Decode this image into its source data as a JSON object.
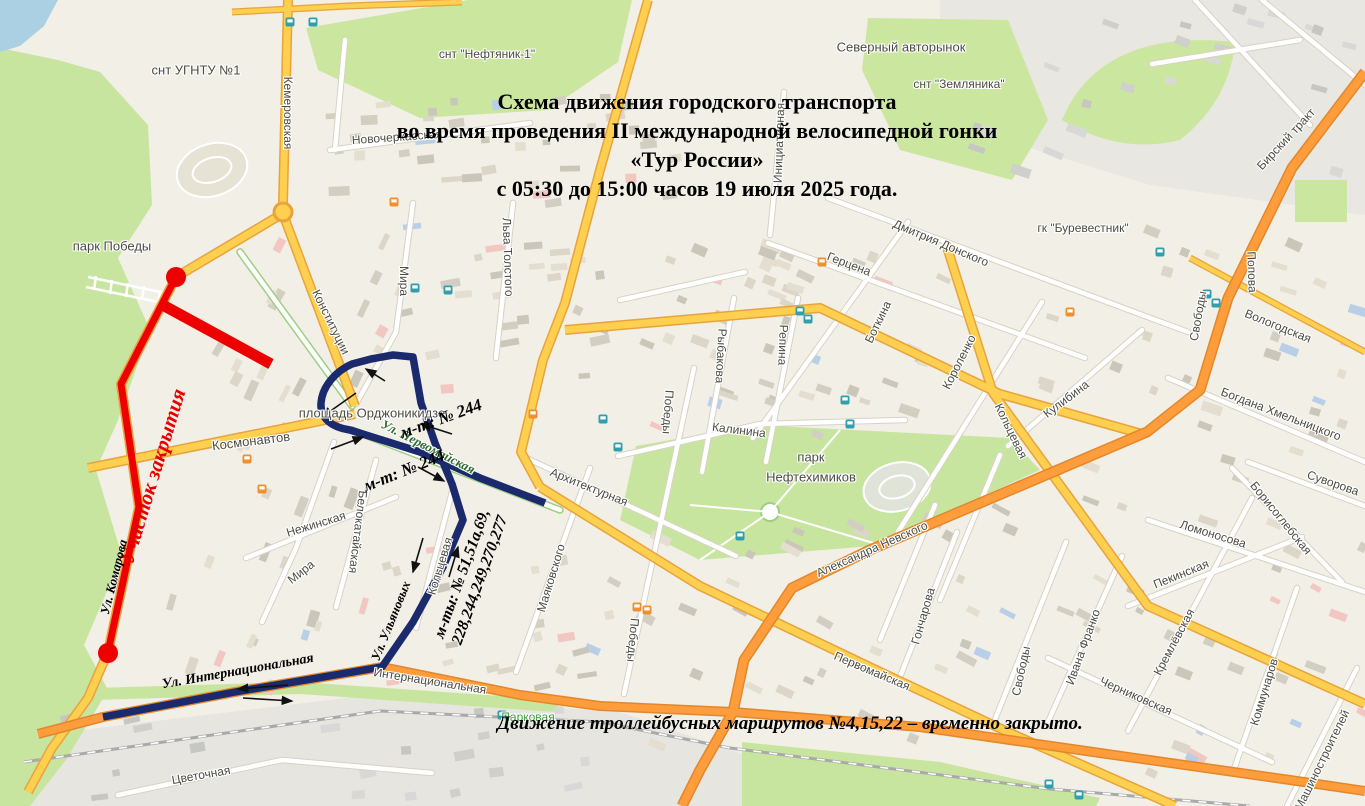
{
  "title": {
    "line1": "Схема движения городского транспорта",
    "line2": "во время проведения II международной велосипедной гонки",
    "line3": "«Тур России»",
    "line4": "с 05:30 до 15:00 часов 19 июля 2025 года."
  },
  "note": "Движение троллейбусных маршрутов №4,15,22 – временно закрыто.",
  "route_annotations": {
    "closed_section": "Участок закрытия",
    "detour_244_first": "м-т: № 244",
    "detour_244_second": "м-т: № 244",
    "detour_list_line1": "м-ты: № 51,51а,69,",
    "detour_list_line2": "228,244,249,270,277",
    "street_international": "Ул. Интернациональная",
    "street_komarova": "Ул. Комарова",
    "street_ulyanovykh": "Ул. Ульяновых"
  },
  "colors": {
    "closed_route_red": "#ee0000",
    "detour_route_navy": "#1a2a6c",
    "main_road_yellow": "#ffcf4f",
    "trunk_road_orange": "#ff9d3c",
    "park_green": "#c8e5a0",
    "water_blue": "#abcfe3",
    "bus_stop_teal": "#2f9fae",
    "tram_stop_orange": "#ef8f2d"
  },
  "icons": {
    "bus_stop_icon": "teal rounded square transit stop",
    "tram_stop_icon": "orange rounded square tram stop"
  },
  "map_labels": [
    {
      "t": "снт УГНТУ №1",
      "x": 196,
      "y": 70,
      "r": 0,
      "s": 13
    },
    {
      "t": "Кемеровская",
      "x": 288,
      "y": 113,
      "r": 90,
      "s": 12
    },
    {
      "t": "Новочеркасская",
      "x": 397,
      "y": 137,
      "r": -4,
      "s": 12
    },
    {
      "t": "парк Победы",
      "x": 112,
      "y": 246,
      "r": 0,
      "s": 13
    },
    {
      "t": "Мира",
      "x": 404,
      "y": 281,
      "r": 90,
      "s": 12
    },
    {
      "t": "Льва Толстого",
      "x": 508,
      "y": 257,
      "r": 88,
      "s": 12
    },
    {
      "t": "Конституции",
      "x": 331,
      "y": 322,
      "r": 64,
      "s": 12
    },
    {
      "t": "снт \"Нефтяник-1\"",
      "x": 487,
      "y": 54,
      "r": 0,
      "s": 12
    },
    {
      "t": "Инициативная",
      "x": 779,
      "y": 143,
      "r": -88,
      "s": 12
    },
    {
      "t": "Северный авторынок",
      "x": 901,
      "y": 47,
      "r": 0,
      "s": 13
    },
    {
      "t": "снт \"Земляника\"",
      "x": 959,
      "y": 84,
      "r": 0,
      "s": 12
    },
    {
      "t": "Дмитрия Донского",
      "x": 941,
      "y": 243,
      "r": 23,
      "s": 12
    },
    {
      "t": "гк \"Буревестник\"",
      "x": 1083,
      "y": 228,
      "r": 0,
      "s": 12
    },
    {
      "t": "Бирский тракт",
      "x": 1286,
      "y": 139,
      "r": -47,
      "s": 12
    },
    {
      "t": "Попова",
      "x": 1252,
      "y": 272,
      "r": 88,
      "s": 12
    },
    {
      "t": "Герцена",
      "x": 849,
      "y": 264,
      "r": 21,
      "s": 12
    },
    {
      "t": "Боткина",
      "x": 878,
      "y": 322,
      "r": -64,
      "s": 12
    },
    {
      "t": "Короленко",
      "x": 959,
      "y": 362,
      "r": -63,
      "s": 12
    },
    {
      "t": "Рыбакова",
      "x": 721,
      "y": 356,
      "r": 93,
      "s": 12
    },
    {
      "t": "Репина",
      "x": 783,
      "y": 345,
      "r": 92,
      "s": 12
    },
    {
      "t": "Победы",
      "x": 668,
      "y": 412,
      "r": 94,
      "s": 12
    },
    {
      "t": "Победы",
      "x": 633,
      "y": 640,
      "r": 95,
      "s": 12
    },
    {
      "t": "Калинина",
      "x": 739,
      "y": 430,
      "r": 7,
      "s": 12
    },
    {
      "t": "парк",
      "x": 811,
      "y": 457,
      "r": 0,
      "s": 13
    },
    {
      "t": "Нефтехимиков",
      "x": 811,
      "y": 477,
      "r": 0,
      "s": 13
    },
    {
      "t": "Архитектурная",
      "x": 589,
      "y": 487,
      "r": 22,
      "s": 12
    },
    {
      "t": "Маяковского",
      "x": 551,
      "y": 578,
      "r": -73,
      "s": 12
    },
    {
      "t": "Александра Невского",
      "x": 872,
      "y": 549,
      "r": -24,
      "s": 12
    },
    {
      "t": "Гончарова",
      "x": 923,
      "y": 616,
      "r": -74,
      "s": 12
    },
    {
      "t": "Первомайская",
      "x": 872,
      "y": 671,
      "r": 23,
      "s": 12
    },
    {
      "t": "Свободы",
      "x": 1021,
      "y": 671,
      "r": -78,
      "s": 12
    },
    {
      "t": "Ивана Франко",
      "x": 1083,
      "y": 647,
      "r": -70,
      "s": 12
    },
    {
      "t": "Черниковская",
      "x": 1136,
      "y": 696,
      "r": 24,
      "s": 12
    },
    {
      "t": "Кремлёвская",
      "x": 1174,
      "y": 642,
      "r": -62,
      "s": 12
    },
    {
      "t": "Пекинская",
      "x": 1181,
      "y": 574,
      "r": -22,
      "s": 12
    },
    {
      "t": "Коммунаров",
      "x": 1264,
      "y": 692,
      "r": -73,
      "s": 12
    },
    {
      "t": "Машиностроителей",
      "x": 1322,
      "y": 760,
      "r": -64,
      "s": 12
    },
    {
      "t": "Суворова",
      "x": 1333,
      "y": 483,
      "r": 19,
      "s": 12
    },
    {
      "t": "Борисоглебская",
      "x": 1281,
      "y": 518,
      "r": 51,
      "s": 12
    },
    {
      "t": "Ломоносова",
      "x": 1213,
      "y": 534,
      "r": 17,
      "s": 12
    },
    {
      "t": "Богдана Хмельницкого",
      "x": 1281,
      "y": 414,
      "r": 21,
      "s": 12
    },
    {
      "t": "Вологодская",
      "x": 1278,
      "y": 326,
      "r": 22,
      "s": 12
    },
    {
      "t": "Свободы",
      "x": 1198,
      "y": 316,
      "r": -80,
      "s": 12
    },
    {
      "t": "Кулибина",
      "x": 1066,
      "y": 399,
      "r": -37,
      "s": 12
    },
    {
      "t": "Кольцевая",
      "x": 1011,
      "y": 431,
      "r": 64,
      "s": 12
    },
    {
      "t": "Кольцевая",
      "x": 440,
      "y": 566,
      "r": -73,
      "s": 12
    },
    {
      "t": "Белокатайская",
      "x": 358,
      "y": 532,
      "r": 97,
      "s": 12
    },
    {
      "t": "Космонавтов",
      "x": 251,
      "y": 441,
      "r": -7,
      "s": 13
    },
    {
      "t": "площадь Орджоникидзе",
      "x": 372,
      "y": 413,
      "r": 0,
      "s": 13
    },
    {
      "t": "Ул. Первомайская",
      "x": 428,
      "y": 447,
      "r": 27,
      "s": 13,
      "c": "serifgreen"
    },
    {
      "t": "Интернациональная",
      "x": 430,
      "y": 681,
      "r": 9,
      "s": 12
    },
    {
      "t": "Парковая",
      "x": 528,
      "y": 717,
      "r": 0,
      "s": 12,
      "c": "green"
    },
    {
      "t": "Цветочная",
      "x": 201,
      "y": 775,
      "r": -10,
      "s": 12
    },
    {
      "t": "Нежинская",
      "x": 316,
      "y": 524,
      "r": -17,
      "s": 12
    },
    {
      "t": "Мира",
      "x": 301,
      "y": 572,
      "r": -38,
      "s": 12
    }
  ]
}
